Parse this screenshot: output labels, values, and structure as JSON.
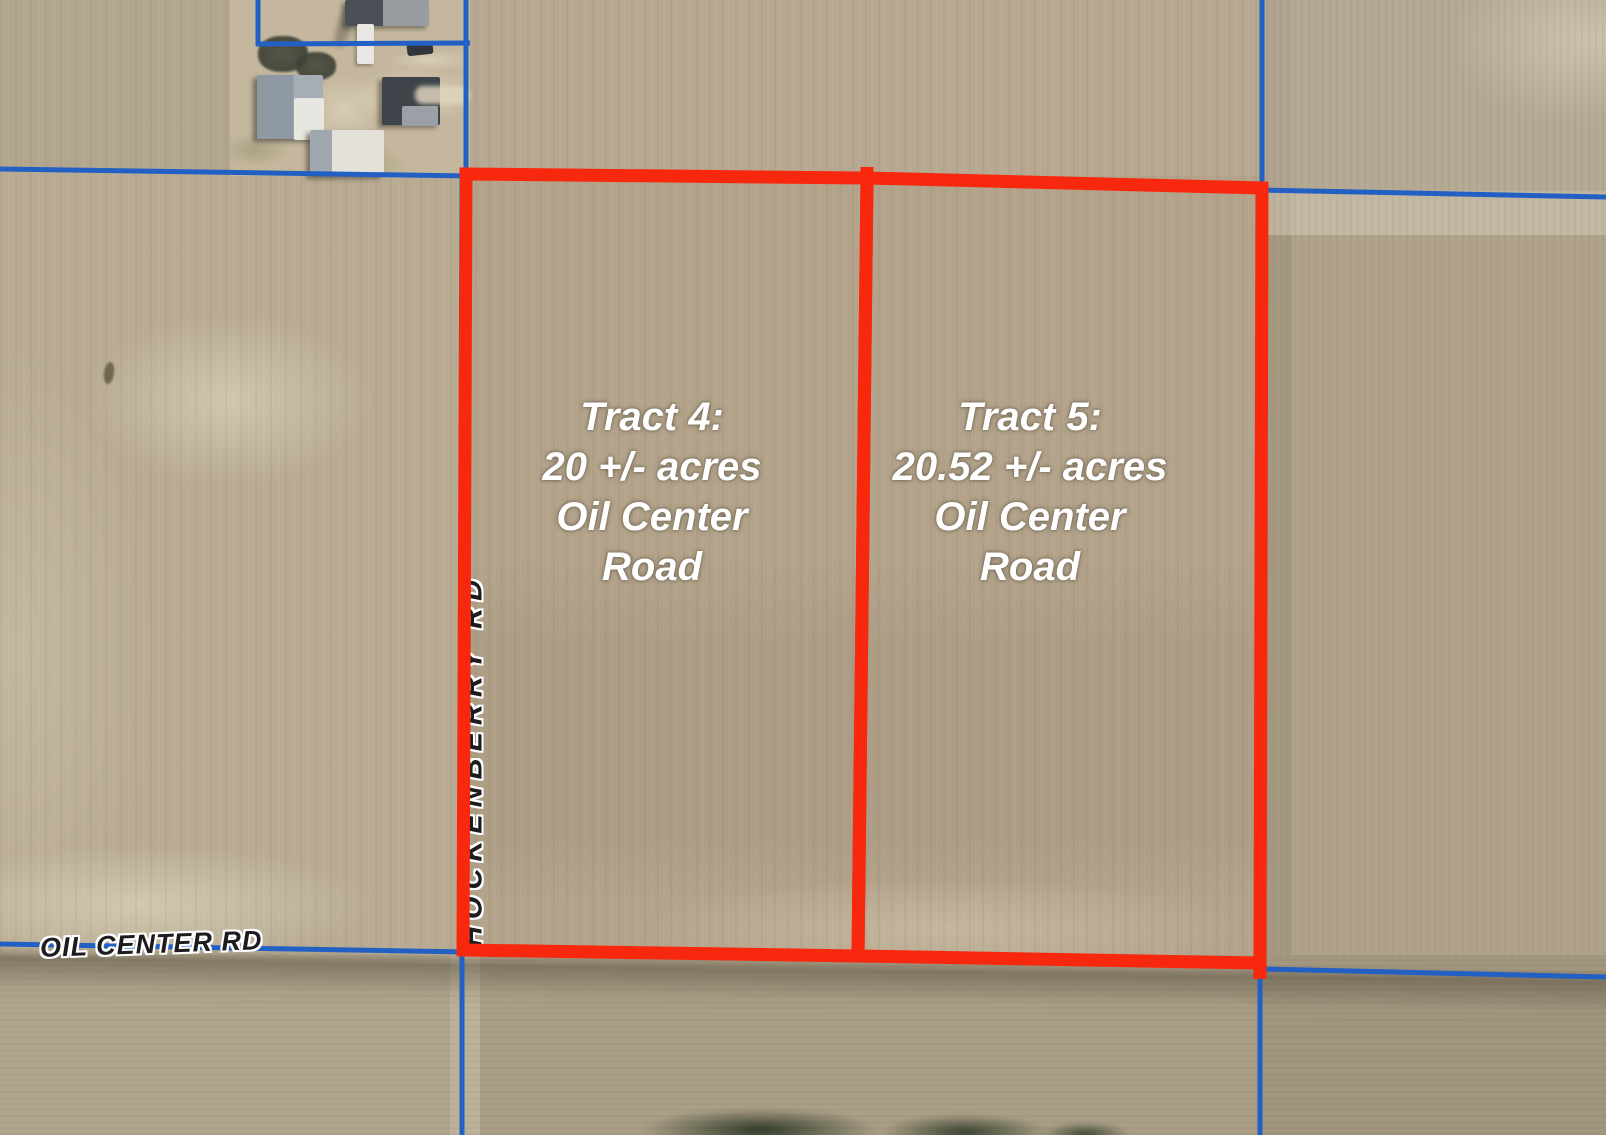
{
  "tracts": [
    {
      "id": "tract-4",
      "lines": [
        "Tract 4:",
        "20 +/- acres",
        "Oil Center",
        "Road"
      ]
    },
    {
      "id": "tract-5",
      "lines": [
        "Tract 5:",
        "20.52 +/- acres",
        "Oil Center",
        "Road"
      ]
    }
  ],
  "road_labels": {
    "oil_center_rd": "OIL CENTER RD",
    "hockenberry_rd": "HOCKENBERRY RD"
  },
  "colors": {
    "tract_boundary_red": "#f8280e",
    "parcel_line_blue": "#2360c4",
    "survey_line_cyan": "#3fd9e4",
    "tract_label_text": "#ffffff",
    "road_label_text": "#1c1c1e"
  }
}
